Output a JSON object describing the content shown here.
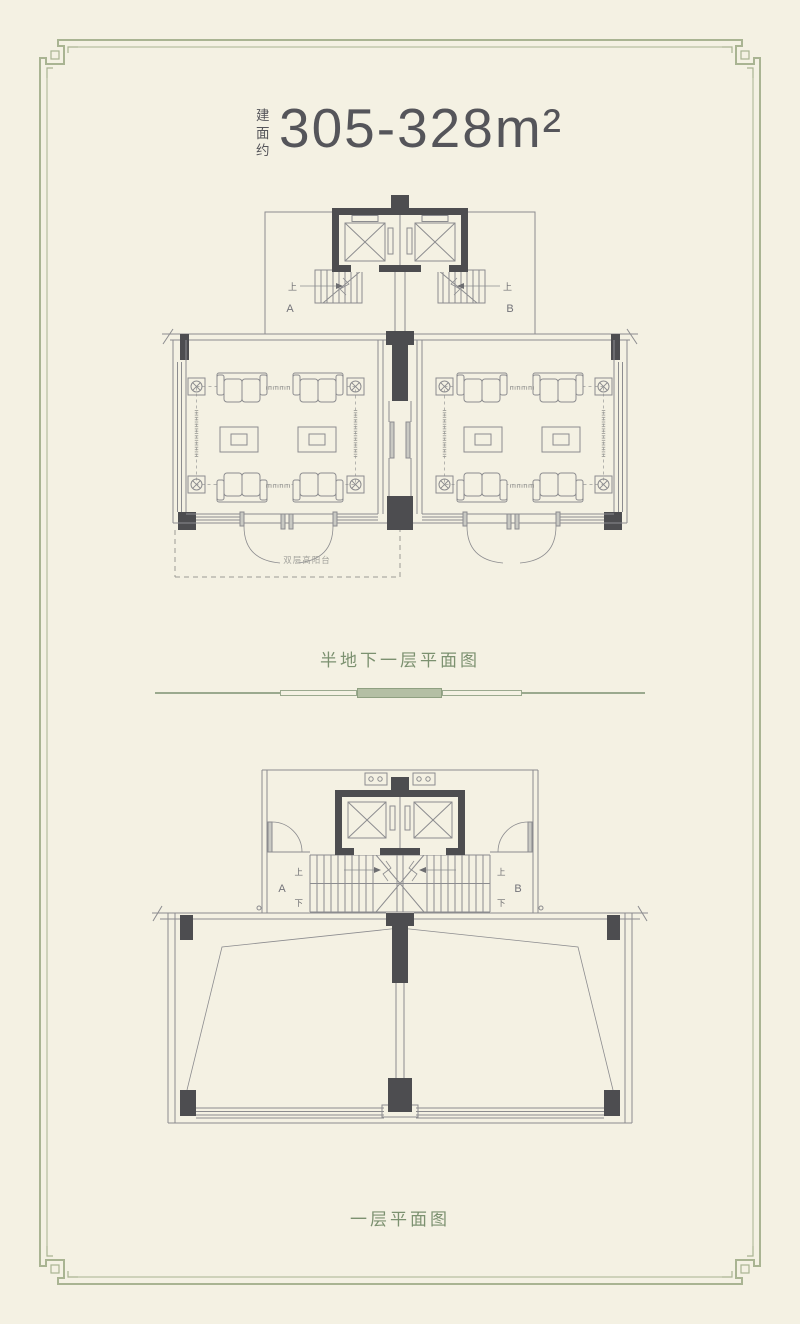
{
  "header": {
    "area_prefix": "建面约",
    "area_value": "305-328m²"
  },
  "plans": [
    {
      "caption": "半地下一层平面图",
      "unit_a": "A",
      "unit_b": "B",
      "stair_up_left": "上",
      "stair_up_right": "上",
      "balcony_label": "双层高阳台"
    },
    {
      "caption": "一层平面图",
      "unit_a": "A",
      "unit_b": "B",
      "stair_up_left": "上",
      "stair_up_right": "上",
      "stair_down_left": "下",
      "stair_down_right": "下"
    }
  ],
  "colors": {
    "background": "#f4f1e3",
    "border_green": "#a9b492",
    "caption_green": "#7c9170",
    "wall_dark": "#4d4d50",
    "line_gray": "#8c8c8f",
    "title_text": "#55555a"
  }
}
